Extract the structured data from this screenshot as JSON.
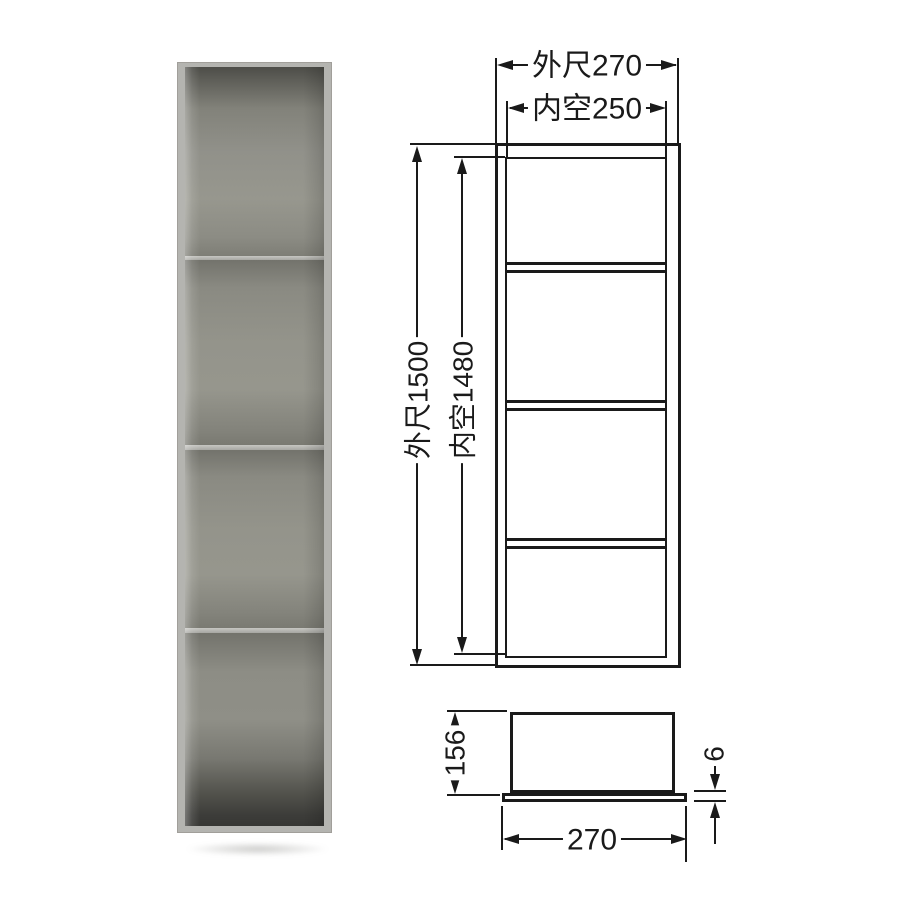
{
  "page": {
    "background": "#ffffff",
    "line_color": "#1a1a1a"
  },
  "photo": {
    "subject": "wall niche shelf with four compartments",
    "compartment_count": 4,
    "frame_color": "#b4b4b0",
    "interior_color": "#94948b",
    "shadow_color": "#6e6e69"
  },
  "front_view": {
    "outer_width_label": "外尺270",
    "inner_width_label": "内空250",
    "outer_height_label": "外尺1500",
    "inner_height_label": "内空1480",
    "shelf_divider_count": 3,
    "compartment_count": 4
  },
  "side_view": {
    "height_label": "156",
    "flange_thickness_label": "6",
    "width_label": "270"
  }
}
